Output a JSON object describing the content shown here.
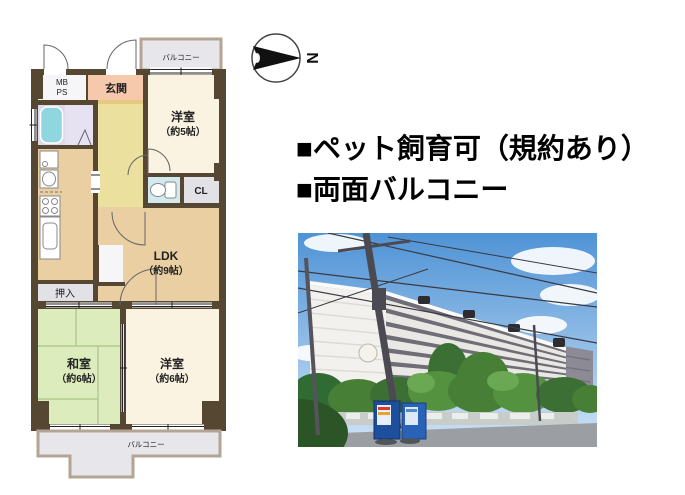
{
  "floorplan": {
    "balcony_top_label": "バルコニー",
    "mb_label": "MB",
    "ps_label": "PS",
    "genkan_label": "玄関",
    "room5_name": "洋室",
    "room5_size": "（約5帖）",
    "cl_label": "CL",
    "ldk_name": "LDK",
    "ldk_size": "（約9帖）",
    "oshiire_label": "押入",
    "washitsu_name": "和室",
    "washitsu_size": "（約6帖）",
    "room6_name": "洋室",
    "room6_size": "（約6帖）",
    "balcony_bottom_label": "バルコニー",
    "colors": {
      "wall": "#564733",
      "ldk_floor": "#e9cfa1",
      "hall_floor": "#ece09f",
      "genkan_floor": "#f6c9ad",
      "western_room": "#fbf3e2",
      "tatami": "#dcecbd",
      "bath": "#ddd8ec",
      "bathtub": "#8fd6de",
      "toilet": "#d2e9f0",
      "closet_gray": "#e2e2e6",
      "balcony_fill": "#e7e7eb",
      "balcony_border": "#b3a493"
    }
  },
  "compass": {
    "north_label": "N"
  },
  "highlights": {
    "line1": "■ペット飼育可（規約あり）",
    "line2": "■両面バルコニー"
  },
  "photo": {
    "label": "building-exterior-photo"
  }
}
